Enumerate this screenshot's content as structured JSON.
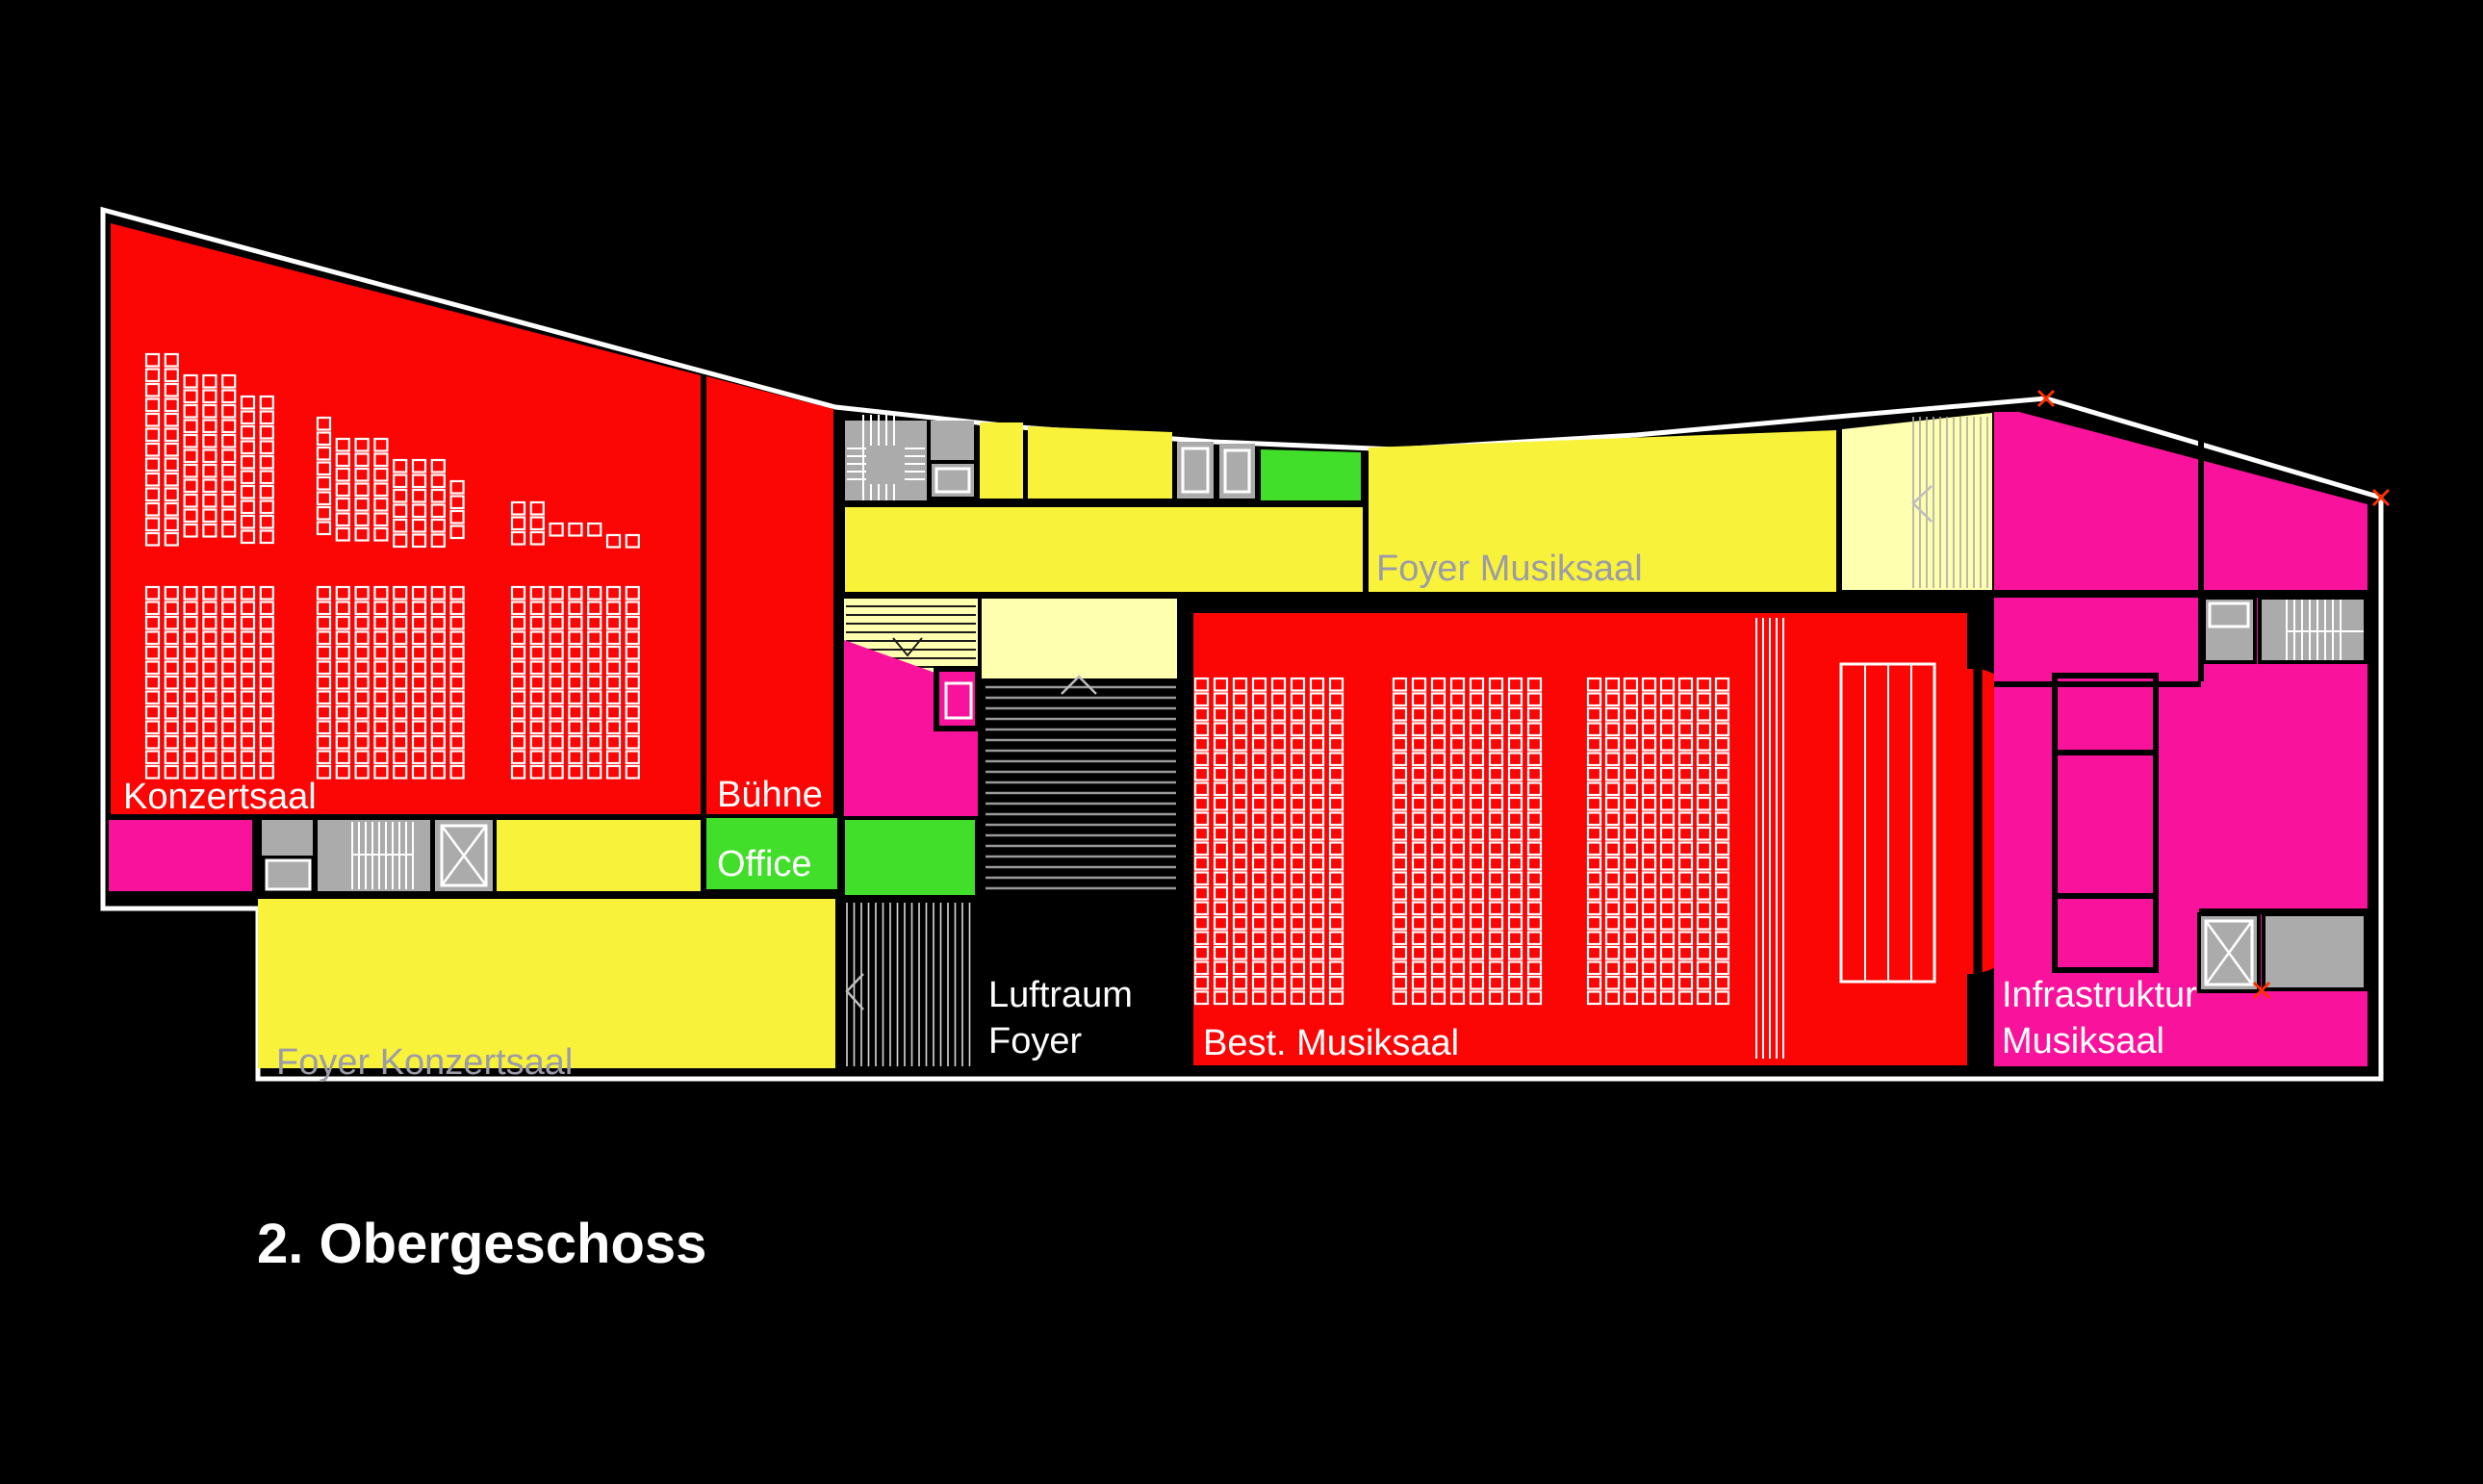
{
  "title": "2. Obergeschoss",
  "labels": {
    "konzertsaal": "Konzertsaal",
    "buehne": "Bühne",
    "office": "Office",
    "foyer_konzertsaal": "Foyer Konzertsaal",
    "foyer_musiksaal": "Foyer Musiksaal",
    "luftraum_line1": "Luftraum",
    "luftraum_line2": "Foyer",
    "best_musiksaal": "Best. Musiksaal",
    "infrastruktur_line1": "Infrastruktur",
    "infrastruktur_line2": "Musiksaal"
  },
  "colors": {
    "background": "#000000",
    "hall_red": "#FB0505",
    "foyer_yellow": "#F8F23B",
    "pale_yellow": "#FFFFB0",
    "infrastructure_magenta": "#F9129B",
    "office_green": "#41DE2A",
    "core_gray": "#ABABAB",
    "outline_white": "#FFFFFF",
    "label_gray": "#9B9BA9",
    "vertex_marker_red": "#FF3000"
  }
}
